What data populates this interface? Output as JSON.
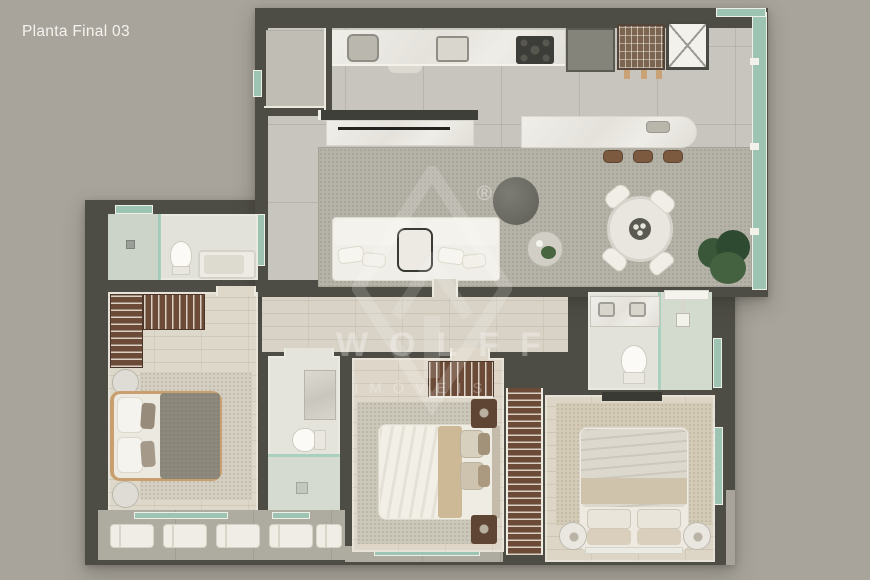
{
  "header": {
    "title": "Planta Final 03"
  },
  "watermark": {
    "brand": "WOLFF",
    "subtitle": "IMÓVEIS",
    "registered": "®"
  },
  "palette": {
    "background": "#a8a49b",
    "walls": "#4e4d45",
    "floor_tile": "#c7c5bd",
    "floor_wood": "#ddd6c8",
    "living_rug": "#b5b2a7",
    "marble": "#eceae4",
    "wood_furniture": "#6b4b37",
    "glass_windows": "#9dc4b3",
    "plants": "#3a5739"
  }
}
